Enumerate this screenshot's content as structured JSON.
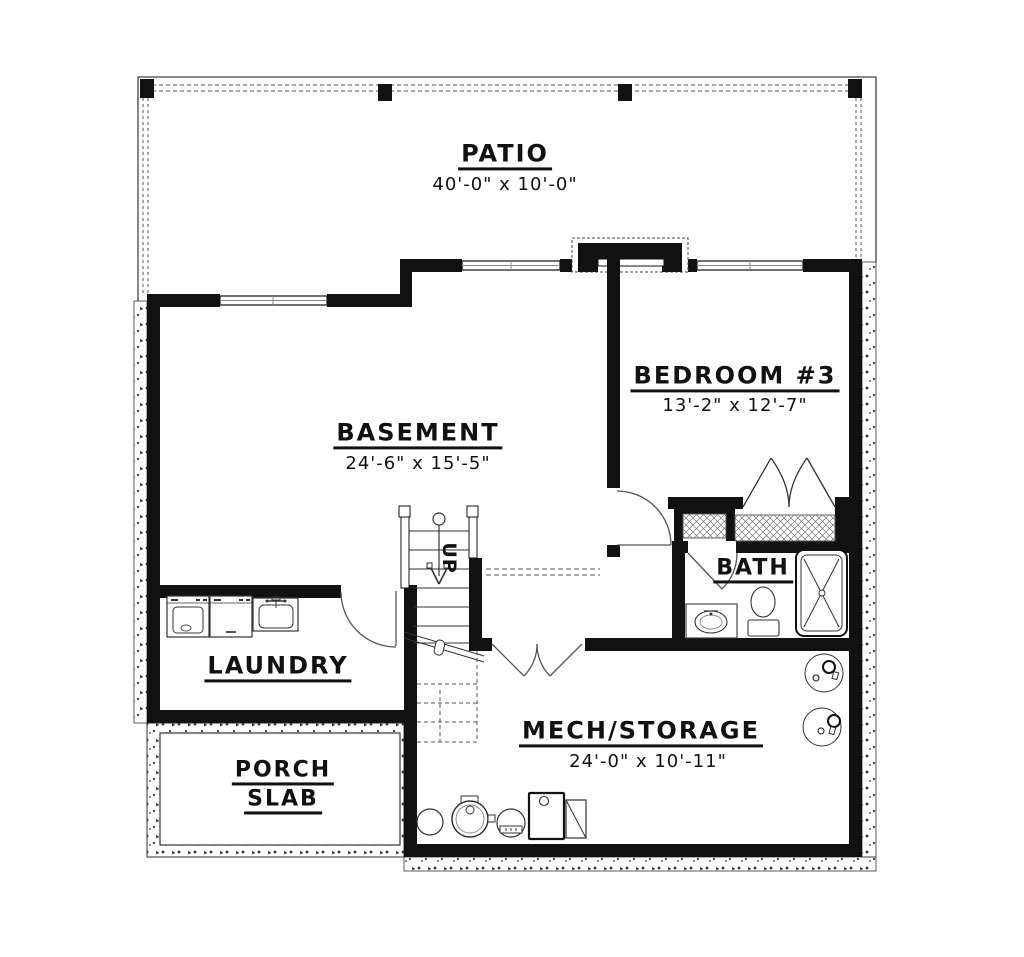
{
  "title": "Basement floor plan",
  "labels": {
    "patio": {
      "name": "PATIO",
      "dims": "40'-0\" x 10'-0\""
    },
    "basement": {
      "name": "BASEMENT",
      "dims": "24'-6\" x 15'-5\""
    },
    "bedroom": {
      "name": "BEDROOM #3",
      "dims": "13'-2\" x 12'-7\""
    },
    "bath": {
      "name": "BATH"
    },
    "laundry": {
      "name": "LAUNDRY"
    },
    "mech": {
      "name": "MECH/STORAGE",
      "dims": "24'-0\" x 10'-11\""
    },
    "porch": {
      "line1": "PORCH",
      "line2": "SLAB"
    },
    "stairs": {
      "direction": "UP"
    }
  },
  "colors": {
    "wall": "#111111",
    "thin_line": "#333333",
    "door_line": "#555555"
  }
}
